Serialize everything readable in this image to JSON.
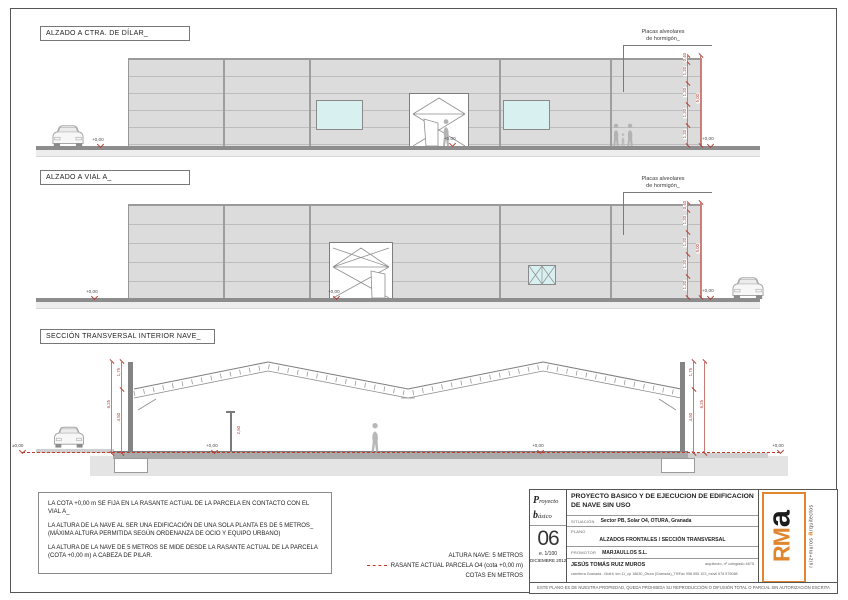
{
  "titles": [
    "ALZADO A CTRA. DE DÍLAR_",
    "ALZADO A VIAL A_",
    "SECCIÓN TRANSVERSAL INTERIOR NAVE_"
  ],
  "placas": {
    "l1": "Placas alveolares",
    "l2": "de hormigón_"
  },
  "levels": {
    "plus": "+0,00",
    "pm": "±0,00"
  },
  "dims": {
    "panel_segments": [
      "0,40",
      "1,20",
      "1,20",
      "1,20",
      "1,20"
    ],
    "panel_total": "5,00",
    "section_segments": [
      "1,75",
      "4,50"
    ],
    "section_total": "6,25",
    "pole": "2,50"
  },
  "notes": [
    "LA COTA +0,00 m SE FIJA EN LA RASANTE ACTUAL DE LA PARCELA EN CONTACTO CON EL VIAL A_",
    "LA ALTURA DE LA NAVE AL SER UNA EDIFICACIÓN DE UNA SOLA PLANTA ES DE 5 METROS_ (MÁXIMA ALTURA PERMITIDA SEGÚN ORDENANZA DE OCIO Y EQUIPO URBANO)",
    "LA ALTURA DE LA NAVE DE 5 METROS SE MIDE DESDE LA RASANTE ACTUAL DE LA PARCELA (COTA +0,00 m) A CABEZA DE PILAR."
  ],
  "legend": {
    "altura": "ALTURA NAVE: 5 METROS",
    "rasante": "RASANTE ACTUAL PARCELA O4 (cota +0,00 m)",
    "cotas": "COTAS EN METROS"
  },
  "titleblock": {
    "brand_line1": "Proyecto",
    "brand_line2": "básico",
    "project_title": "PROYECTO BASICO Y DE EJECUCION DE EDIFICACION DE NAVE SIN USO",
    "situacion_label": "SITUACIÓN",
    "situacion_value": "Sector PB, Solar O4, OTURA, Granada",
    "plano_label": "PLANO",
    "plano_value": "ALZADOS FRONTALES / SECCIÓN TRANSVERSAL",
    "sheet_number": "06",
    "scale": "e. 1/100",
    "date": "DICIEMBRE 2012",
    "promotor_label": "PROMOTOR",
    "promotor_value": "MARJAULLOS S.L.",
    "architect_name": "JESÚS TOMÁS RUIZ MUROS",
    "architect_credentials": "arquitecto, nº colegiado 4675",
    "architect_contact": "carretera Granada - Motril, km 11_cp 18630_Otura (Granada)_Tlf/Fax 958 555 103_móvil 678 575088",
    "disclaimer": "ESTE PLANO ES DE NUESTRA PROPIEDAD, QUEDA PROHIBIDA SU REPRODUCCIÓN O DIFUSIÓN TOTAL O PARCIAL SIN AUTORIZACIÓN ESCRITA",
    "logo_rm": "RM",
    "logo_a": "a",
    "logo_sub1": "ruiz+muros ",
    "logo_sub_a": "a",
    "logo_sub2": "rquitectos"
  },
  "colors": {
    "accent_red": "#b5413a",
    "logo_orange": "#e0862f",
    "facade_gray": "#dcdcdc",
    "window_cyan": "#d9f0f1"
  }
}
